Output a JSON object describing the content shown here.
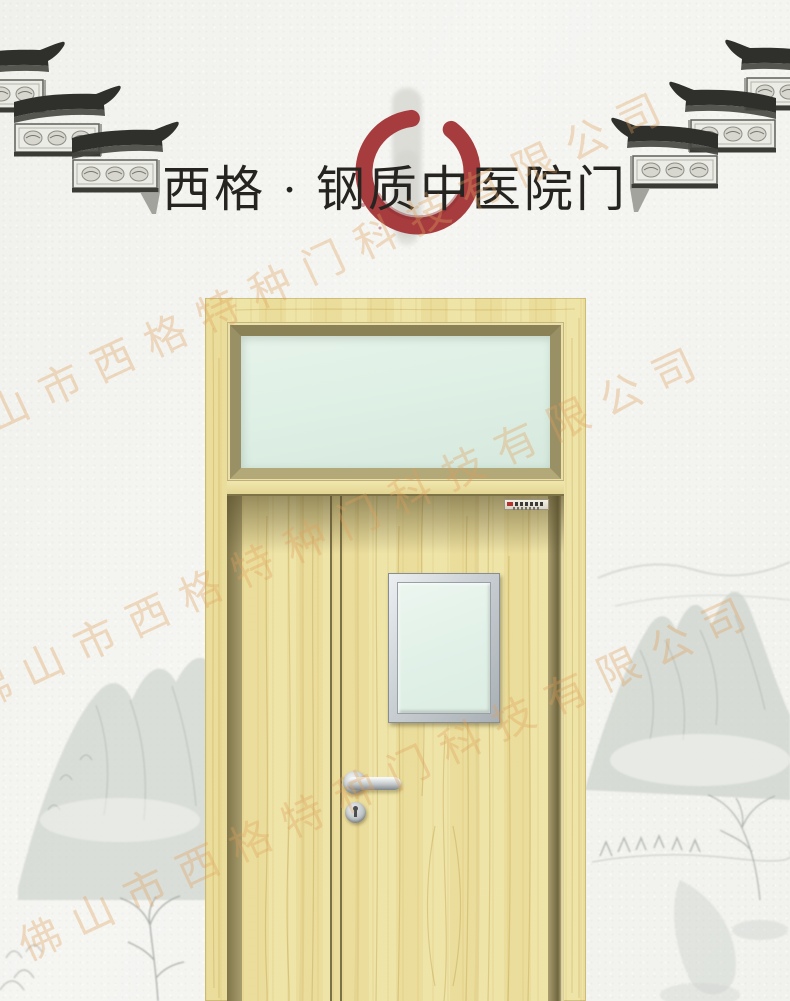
{
  "title": {
    "text": "西格 · 钢质中医院门",
    "brand": "西格",
    "product": "钢质中医院门",
    "ink_color": "#262420"
  },
  "watermark": {
    "text": "佛山市西格特种门科技有限公司",
    "color": "#dfa05c",
    "opacity": 0.35,
    "angle_deg": -25,
    "instances": 3
  },
  "decor": {
    "enso_brush_circle_color": "#a73c3f",
    "ink_wash_color": "#c9cfc9",
    "icons": {
      "eave_left": "chinese-roof-eaves-corner-left",
      "eave_right": "chinese-roof-eaves-corner-right",
      "enso": "red-brush-circle",
      "landscape": "ink-wash-mountains"
    }
  },
  "door": {
    "wood_color": "#eee3a6",
    "frame_bevel_color": "#8a8157",
    "frame_reveal_color": "#a2996b",
    "transom_glass_color": "#e0efe6",
    "vision_panel_glass_color": "#e4f1e9",
    "metal_color": "#c6cbce",
    "parts": [
      "transom-window",
      "narrow-leaf",
      "main-leaf",
      "vision-panel",
      "lever-handle",
      "keyhole-escutcheon",
      "brand-sticker"
    ]
  }
}
